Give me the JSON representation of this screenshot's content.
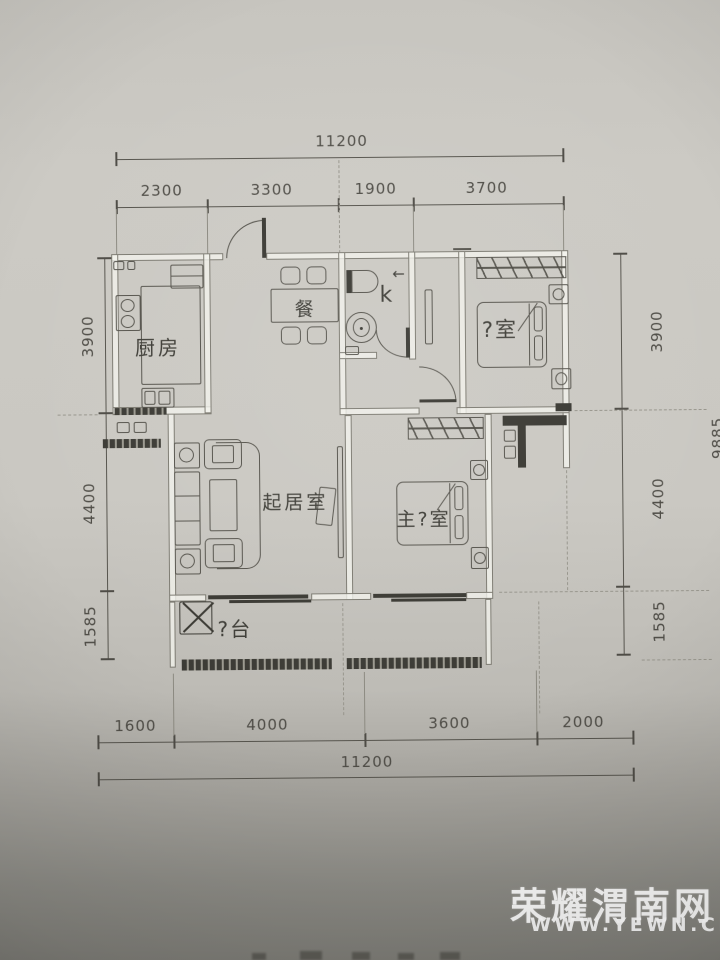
{
  "dimensions": {
    "top": {
      "total": "11200",
      "segments": [
        "2300",
        "3300",
        "1900",
        "3700"
      ]
    },
    "bottom": {
      "total": "11200",
      "segments": [
        "1600",
        "4000",
        "3600",
        "2000"
      ]
    },
    "left": {
      "segments": [
        "3900",
        "4400",
        "1585"
      ]
    },
    "right": {
      "segments": [
        "3900",
        "4400",
        "1585"
      ],
      "overall": "9885"
    }
  },
  "rooms": {
    "kitchen": {
      "label": "厨房"
    },
    "dining": {
      "label": "餐"
    },
    "bath": {
      "label": "k",
      "arrow": "←"
    },
    "bedroom": {
      "label": "?室"
    },
    "living": {
      "label": "起居室"
    },
    "master": {
      "label": "主?室"
    },
    "balcony": {
      "label": "?台"
    }
  },
  "watermark": {
    "site_name": "荣耀渭南网",
    "site_url": "WWW.YEWN.CN"
  },
  "colors": {
    "paper": "#cac8c2",
    "ink": "#56544d",
    "dark_ink": "#3a3933",
    "watermark": "#ffffff"
  }
}
